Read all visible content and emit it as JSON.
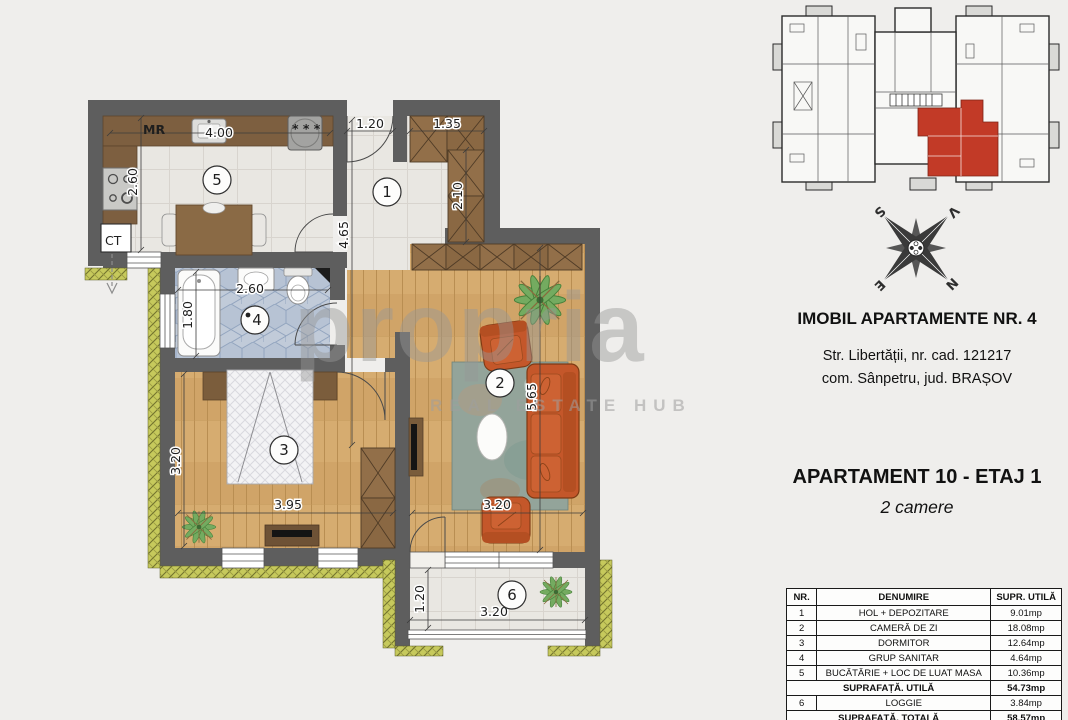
{
  "watermark": {
    "brand": "propria",
    "tagline": "REAL ESTATE HUB"
  },
  "info": {
    "building_title": "IMOBIL APARTAMENTE NR. 4",
    "address_line1": "Str. Libertății, nr. cad. 121217",
    "address_line2": "com. Sânpetru, jud. BRAȘOV",
    "apartment_title": "APARTAMENT 10 - ETAJ 1",
    "apartment_subtitle": "2 camere"
  },
  "compass": {
    "n": "N",
    "s": "S",
    "e": "E",
    "v": "V"
  },
  "plan": {
    "rooms": [
      "1",
      "2",
      "3",
      "4",
      "5",
      "6"
    ],
    "labels": {
      "mr": "MR",
      "ct": "CT",
      "stars": "* * *"
    },
    "dims": {
      "kitchen_w": "4.00",
      "kitchen_h": "2.60",
      "entry": "1.20",
      "ward1": "1.35",
      "ward2": "2.10",
      "hall": "4.65",
      "bath_w": "2.60",
      "bath_h": "1.80",
      "bed_h": "3.20",
      "bed_w": "3.95",
      "living_h": "5.65",
      "living_w": "3.20",
      "loggia_h": "1.20",
      "loggia_w": "3.20"
    }
  },
  "table": {
    "headers": [
      "NR.",
      "DENUMIRE",
      "SUPR. UTILĂ"
    ],
    "rows": [
      {
        "nr": "1",
        "name": "HOL + DEPOZITARE",
        "area": "9.01mp"
      },
      {
        "nr": "2",
        "name": "CAMERĂ DE ZI",
        "area": "18.08mp"
      },
      {
        "nr": "3",
        "name": "DORMITOR",
        "area": "12.64mp"
      },
      {
        "nr": "4",
        "name": "GRUP SANITAR",
        "area": "4.64mp"
      },
      {
        "nr": "5",
        "name": "BUCĂTĂRIE + LOC DE LUAT MASA",
        "area": "10.36mp"
      }
    ],
    "subtotal": {
      "label": "SUPRAFAȚĂ. UTILĂ",
      "area": "54.73mp"
    },
    "loggia_row": {
      "nr": "6",
      "name": "LOGGIE",
      "area": "3.84mp"
    },
    "total": {
      "label": "SUPRAFAȚĂ. TOTALĂ",
      "area": "58.57mp"
    }
  }
}
